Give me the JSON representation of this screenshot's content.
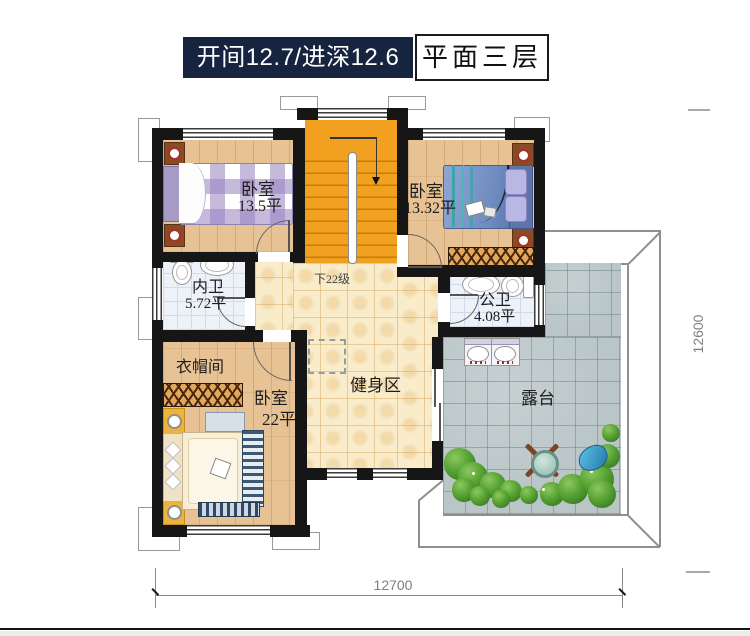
{
  "header": {
    "spec": "开间12.7/进深12.6",
    "floor": "平面三层"
  },
  "rooms": {
    "bedroom_tl": {
      "name": "卧室",
      "area": "13.5平"
    },
    "bedroom_tr": {
      "name": "卧室",
      "area": "13.32平"
    },
    "bath_inner": {
      "name": "内卫",
      "area": "5.72平"
    },
    "bath_public": {
      "name": "公卫",
      "area": "4.08平"
    },
    "cloakroom": {
      "name": "衣帽间"
    },
    "bedroom_b": {
      "name": "卧室",
      "area": "22平"
    },
    "gym": {
      "name": "健身区"
    },
    "terrace": {
      "name": "露台"
    },
    "stairs": {
      "note": "下22级"
    }
  },
  "dimensions": {
    "width": "12700",
    "depth": "12600"
  },
  "colors": {
    "title_bg": "#16243f",
    "stair_orange": "#f2a01f",
    "wall": "#161616",
    "wood_floor": "#e6c294",
    "hall_tile": "#f8eccb",
    "bath_tile": "#edf2f9",
    "terrace_tile": "#b9c5c7",
    "greenery": "#4f9335"
  }
}
